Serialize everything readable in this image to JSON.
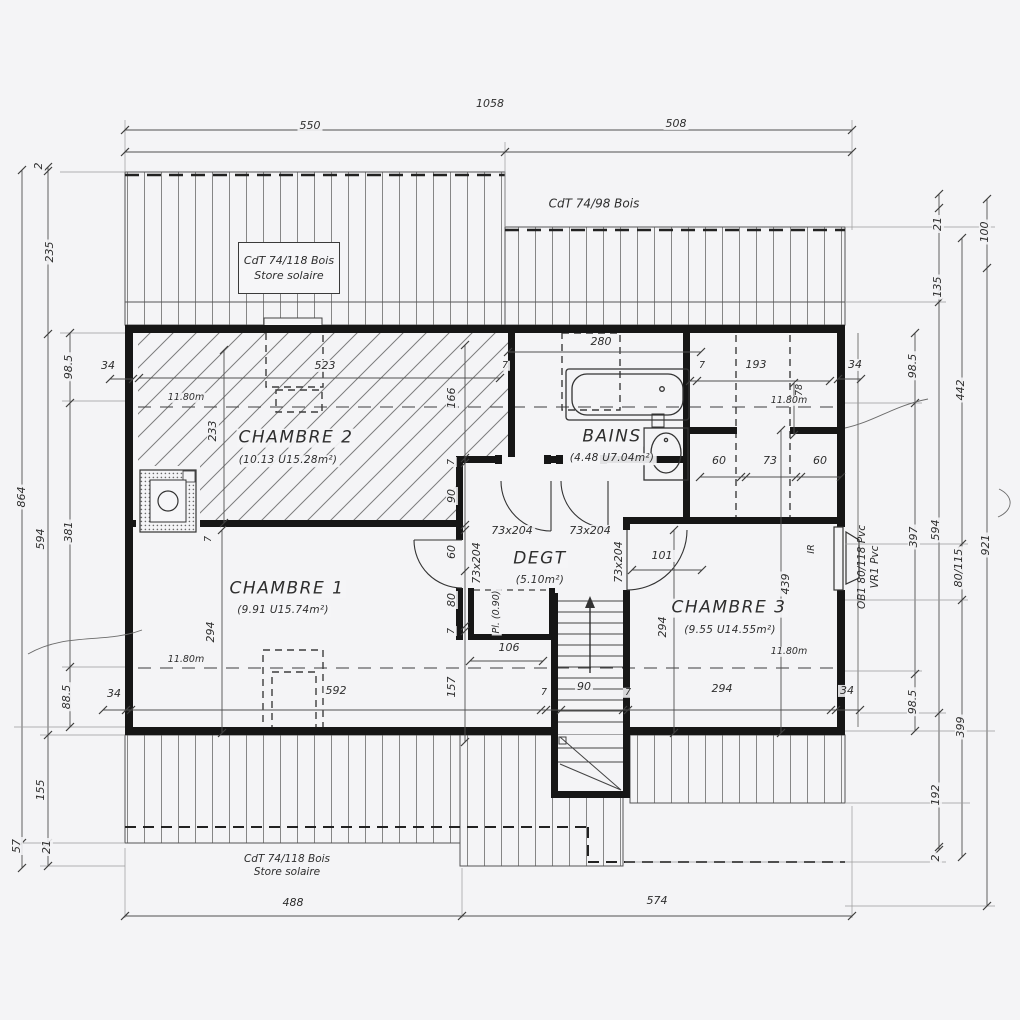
{
  "dims": {
    "top_total": "1058",
    "top_left": "550",
    "top_right": "508",
    "bot_left": "488",
    "bot_right": "574",
    "L_total": "864",
    "L_2": "2",
    "L_235": "235",
    "L_594": "594",
    "L_155": "155",
    "L_21": "21",
    "L_57": "57",
    "L_985": "98.5",
    "L_381": "381",
    "L_885": "88.5",
    "R_21": "21",
    "R_135": "135",
    "R_594": "594",
    "R_192": "192",
    "R_2": "2",
    "R_985a": "98.5",
    "R_397": "397",
    "R_985b": "98.5",
    "R_442": "442",
    "R_80115": "80/115",
    "R_399": "399",
    "R_100": "100",
    "R_921": "921",
    "d34": "34",
    "d7": "7",
    "c2_w": "523",
    "c2_h": "233",
    "v166": "166",
    "v90": "90",
    "v60": "60",
    "v80": "80",
    "v157": "157",
    "w280": "280",
    "w193": "193",
    "v78": "78",
    "s60": "60",
    "s73": "73",
    "w101": "101",
    "w106": "106",
    "b592": "592",
    "b90": "90",
    "b294": "294",
    "c1_294": "294",
    "c3_294": "294",
    "c3_439": "439",
    "height": "11.80m"
  },
  "rooms": {
    "chambre1": {
      "name": "CHAMBRE 1",
      "area": "(9.91 U15.74m²)"
    },
    "chambre2": {
      "name": "CHAMBRE 2",
      "area": "(10.13 U15.28m²)"
    },
    "chambre3": {
      "name": "CHAMBRE 3",
      "area": "(9.55 U14.55m²)"
    },
    "bains": {
      "name": "BAINS",
      "area": "(4.48 U7.04m²)"
    },
    "degt": {
      "name": "DEGT",
      "area": "(5.10m²)"
    },
    "placard": "Pl. (0.90)"
  },
  "doors": {
    "size": "73x204"
  },
  "notes": {
    "roof_left_1": "CdT 74/118 Bois",
    "roof_left_2": "Store solaire",
    "roof_right": "CdT 74/98 Bois",
    "roof_bottom_1": "CdT 74/118 Bois",
    "roof_bottom_2": "Store solaire",
    "window_1": "OB1 80/118 Pvc",
    "window_2": "VR1 Pvc",
    "ir": "IR"
  }
}
